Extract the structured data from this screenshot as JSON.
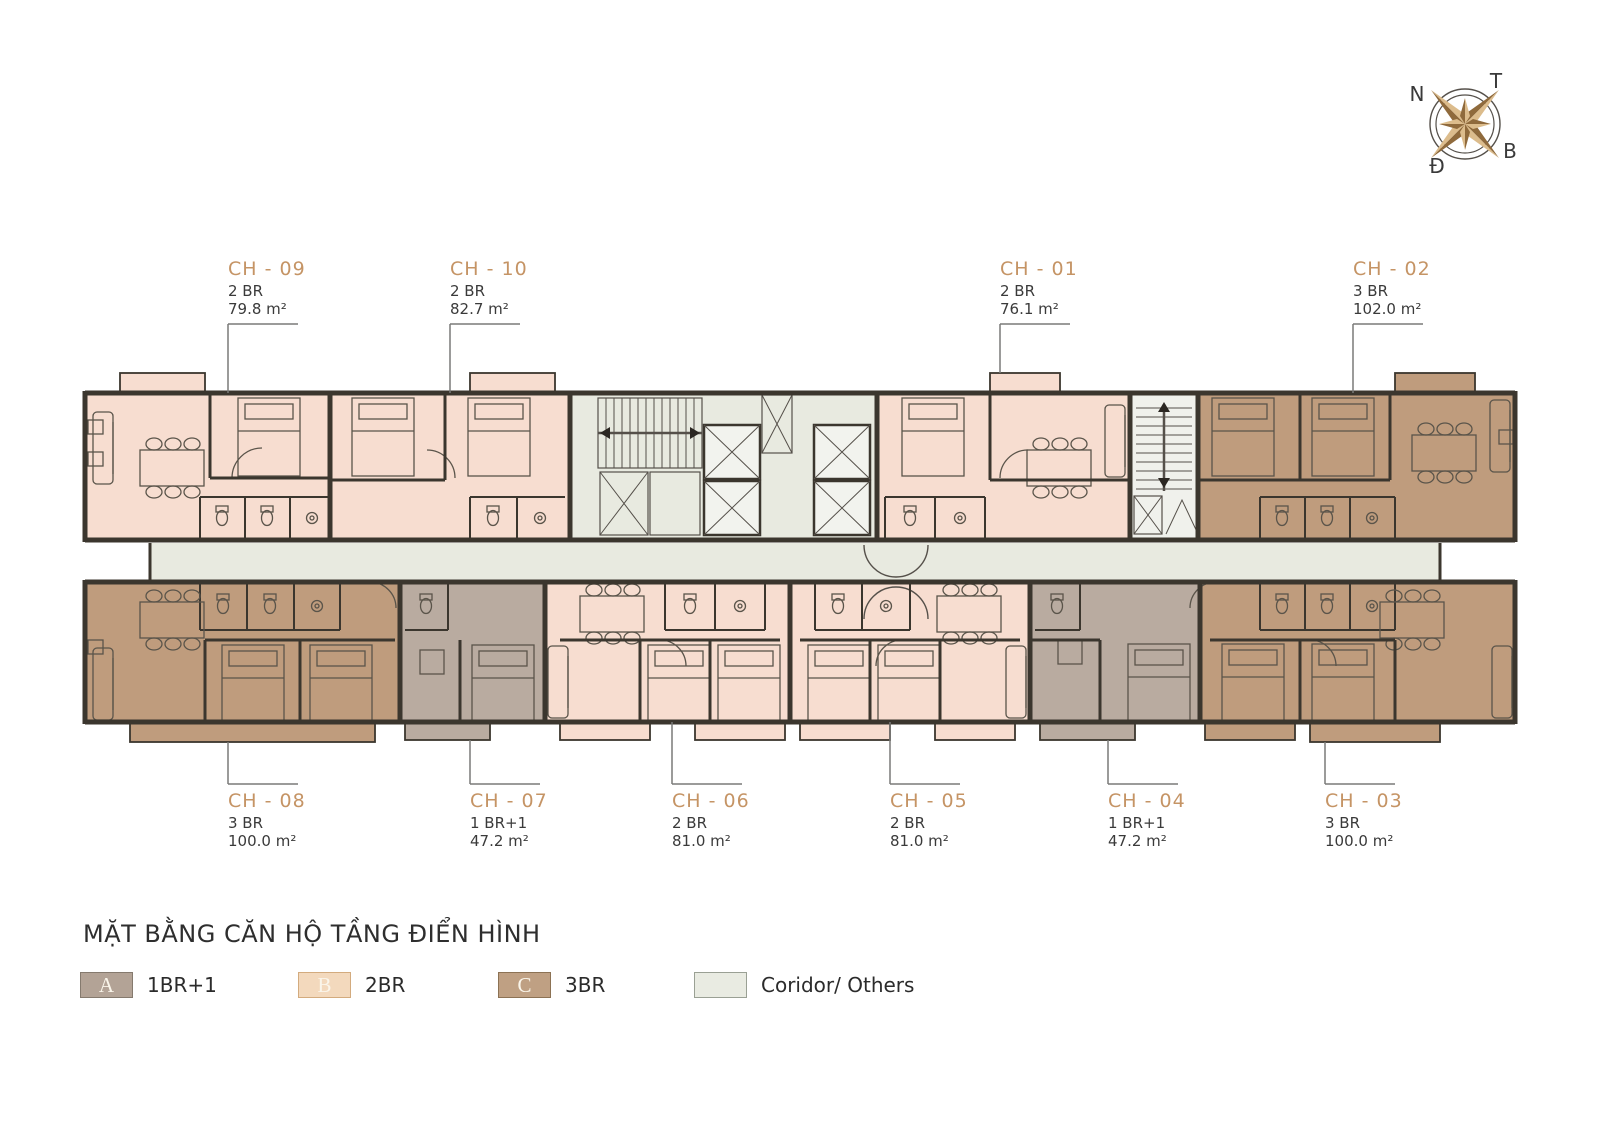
{
  "title": "MẶT BẰNG CĂN HỘ TẦNG ĐIỂN HÌNH",
  "compass": {
    "n": "N",
    "t": "T",
    "b": "B",
    "d": "Đ"
  },
  "units": {
    "ch01": {
      "id": "CH - 01",
      "type": "2 BR",
      "area": "76.1 m²"
    },
    "ch02": {
      "id": "CH - 02",
      "type": "3 BR",
      "area": "102.0 m²"
    },
    "ch03": {
      "id": "CH - 03",
      "type": "3 BR",
      "area": "100.0 m²"
    },
    "ch04": {
      "id": "CH - 04",
      "type": "1 BR+1",
      "area": "47.2 m²"
    },
    "ch05": {
      "id": "CH - 05",
      "type": "2 BR",
      "area": "81.0 m²"
    },
    "ch06": {
      "id": "CH - 06",
      "type": "2 BR",
      "area": "81.0 m²"
    },
    "ch07": {
      "id": "CH - 07",
      "type": "1 BR+1",
      "area": "47.2 m²"
    },
    "ch08": {
      "id": "CH - 08",
      "type": "3 BR",
      "area": "100.0 m²"
    },
    "ch09": {
      "id": "CH - 09",
      "type": "2 BR",
      "area": "79.8 m²"
    },
    "ch10": {
      "id": "CH - 10",
      "type": "2 BR",
      "area": "82.7 m²"
    }
  },
  "legend": {
    "items": [
      {
        "letter": "A",
        "label": "1BR+1",
        "color": "#b3a396"
      },
      {
        "letter": "B",
        "label": "2BR",
        "color": "#f3d9bd"
      },
      {
        "letter": "C",
        "label": "3BR",
        "color": "#bfa083"
      },
      {
        "letter": "",
        "label": "Coridor/ Others",
        "color": "#e9ebe2"
      }
    ]
  },
  "colors": {
    "unit_2br": "#f7ddd0",
    "unit_3br": "#bf9c7d",
    "unit_1br1": "#b9aba0",
    "corridor": "#e8eae0",
    "wall": "#3b362e",
    "accent_label": "#c59465"
  }
}
